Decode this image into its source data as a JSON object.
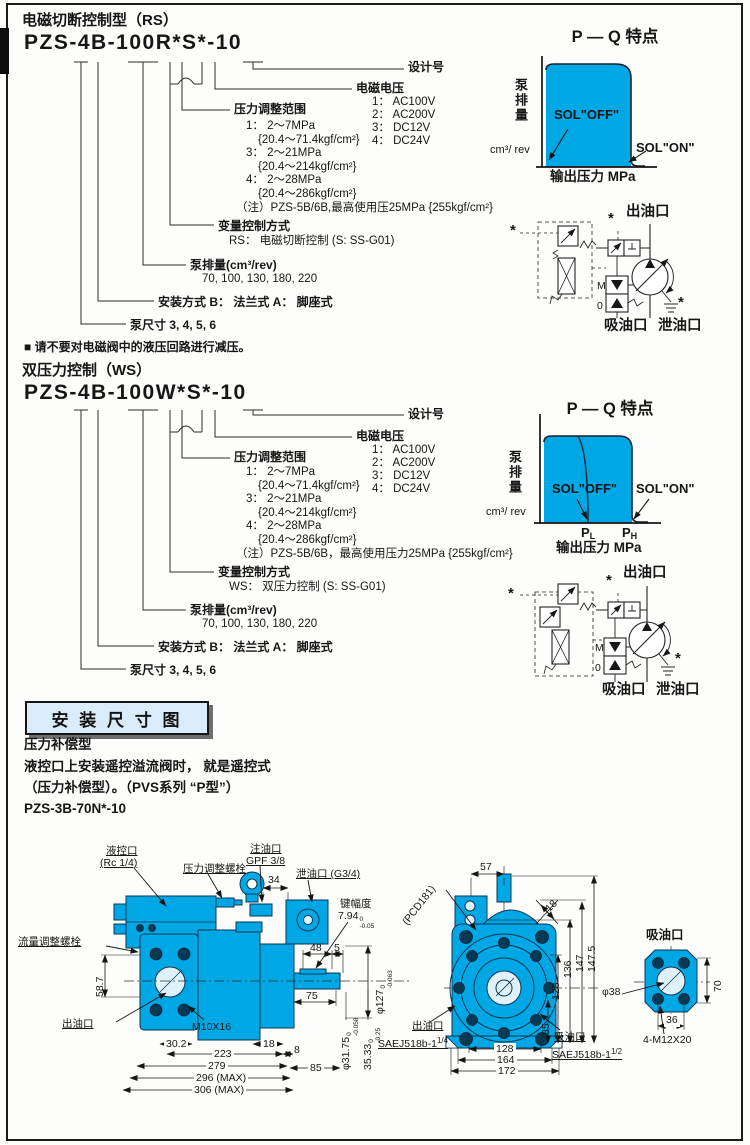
{
  "colors": {
    "accent_cyan": "#00a7e5",
    "header_bg": "#d9ecf9",
    "ink": "#161616"
  },
  "page": {
    "note": "■ 请不要对电磁阀中的液压回路进行减压。"
  },
  "rs": {
    "section_title": "电磁切断控制型（RS）",
    "model_code": "PZS-4B-100R*S*-10",
    "design_no_label": "设计号",
    "voltage_label": "电磁电压",
    "voltage_items": [
      "1： AC100V",
      "2： AC200V",
      "3： DC12V",
      "4： DC24V"
    ],
    "pressure_label": "压力调整范围",
    "pressure_items": [
      "1： 2～7MPa",
      "{20.4～71.4kgf/cm²}",
      "3： 2～21MPa",
      "{20.4～214kgf/cm²}",
      "4： 2～28MPa",
      "{20.4～286kgf/cm²}"
    ],
    "pressure_note": "（注）PZS-5B/6B,最高使用压25MPa {255kgf/cm²}",
    "control_label": "变量控制方式",
    "control_value": "RS： 电磁切断控制  (S: SS-G01)",
    "disp_label": "泵排量(cm³/rev)",
    "disp_value": "70, 100, 130, 180, 220",
    "mount_label": "安装方式  B： 法兰式  A： 脚座式",
    "size_label": "泵尺寸  3, 4, 5, 6"
  },
  "ws": {
    "section_title": "双压力控制（WS）",
    "model_code": "PZS-4B-100W*S*-10",
    "design_no_label": "设计号",
    "voltage_label": "电磁电压",
    "voltage_items": [
      "1： AC100V",
      "2： AC200V",
      "3： DC12V",
      "4： DC24V"
    ],
    "pressure_label": "压力调整范围",
    "pressure_items": [
      "1： 2～7MPa",
      "{20.4～71.4kgf/cm²}",
      "3： 2～21MPa",
      "{20.4～214kgf/cm²}",
      "4： 2～28MPa",
      "{20.4～286kgf/cm²}"
    ],
    "pressure_note": "（注）PZS-5B/6B，最高使用压力25MPa {255kgf/cm²}",
    "control_label": "变量控制方式",
    "control_value": "WS： 双压力控制  (S: SS-G01)",
    "disp_label": "泵排量(cm³/rev)",
    "disp_value": "70, 100, 130, 180, 220",
    "mount_label": "安装方式  B： 法兰式  A： 脚座式",
    "size_label": "泵尺寸  3, 4, 5, 6"
  },
  "chart_rs": {
    "title": "P — Q 特点",
    "ylabel": "泵排量",
    "yunit": "cm³/ rev",
    "xlabel": "输出压力  MPa",
    "sol_off": "SOL\"OFF\"",
    "sol_on": "SOL\"ON\""
  },
  "chart_ws": {
    "title": "P — Q 特点",
    "ylabel": "泵排量",
    "yunit": "cm³/ rev",
    "xlabel": "输出压力  MPa",
    "sol_off": "SOL\"OFF\"",
    "sol_on": "SOL\"ON\"",
    "pl_main": "P",
    "pl_sub": "L",
    "ph_main": "P",
    "ph_sub": "H"
  },
  "circuit_rs": {
    "outlet": "出油口",
    "suction": "吸油口",
    "drain": "泄油口",
    "star": "*",
    "m": "M",
    "zero": "0"
  },
  "circuit_ws": {
    "outlet": "出油口",
    "suction": "吸油口",
    "drain": "泄油口",
    "star": "*",
    "m": "M",
    "zero": "0"
  },
  "install": {
    "header": "安 装 尺 寸 图",
    "line1": "压力补偿型",
    "line2": "液控口上安装遥控溢流阀时， 就是遥控式",
    "line3": "（压力补偿型）。（PVS系列 “P型”）",
    "line4": "PZS-3B-70N*-10"
  },
  "side_view": {
    "pilot_port1": "液控口",
    "pilot_port2": "(Rc  1/4)",
    "pressure_screw": "压力调整螺栓",
    "fill_port1": "注油口",
    "fill_port2": "GPF 3/8",
    "d34": "34",
    "drain_port": "泄油口 (G3/4)",
    "key_label": "键幅度",
    "key_value": "7.94",
    "key_tol_top": "0",
    "key_tol_bot": "-0.05",
    "d48": "48",
    "d5": "5",
    "flow_screw": "流量调整螺栓",
    "d587": "58.7",
    "out_port": "出油口",
    "m10": "M10X16",
    "d302": "30.2",
    "d223": "223",
    "d279": "279",
    "d296": "296 (MAX)",
    "d306": "306 (MAX)",
    "d75": "75",
    "d18": "18",
    "d8": "8",
    "d85": "85",
    "phi127": "φ127",
    "phi127_top": "0",
    "phi127_bot": "-0.063",
    "phi3175": "φ31.75",
    "phi3175_top": "0",
    "phi3175_bot": "-0.058",
    "d3533": "35.33",
    "d3533_top": "0",
    "d3533_bot": "-0.25"
  },
  "front_view": {
    "d57": "57",
    "pcd": "(PCD181)",
    "d18": "18",
    "d136": "136",
    "d147": "147",
    "d1475": "147.5",
    "d128r": "128",
    "d85": "85",
    "d128": "128",
    "d164": "164",
    "d172": "172",
    "out1": "出油口",
    "out2": "SAEJ518b-1",
    "out2_sup": "1/4",
    "suc1": "吸油口",
    "suc2": "SAEJ518b-1",
    "suc2_sup": "1/2"
  },
  "flange_view": {
    "title": "吸油口",
    "phi38": "φ38",
    "d70": "70",
    "d36": "36",
    "bolt": "4-M12X20"
  },
  "chart_data": [
    {
      "type": "area",
      "title": "P — Q 特点",
      "xlabel": "输出压力 MPa",
      "ylabel": "泵排量 cm³/rev",
      "annotations": [
        "SOL\"OFF\"",
        "SOL\"ON\""
      ],
      "x_ticks": [],
      "axis_numeric": false,
      "description": "constant full displacement until cutoff pressure, then vertical drop"
    },
    {
      "type": "area",
      "title": "P — Q 特点",
      "xlabel": "输出压力 MPa",
      "ylabel": "泵排量 cm³/rev",
      "annotations": [
        "SOL\"OFF\"",
        "SOL\"ON\""
      ],
      "x_ticks": [
        "PL",
        "PH"
      ],
      "axis_numeric": false,
      "description": "two cutoff pressures: PL when SOL OFF, PH when SOL ON"
    }
  ]
}
